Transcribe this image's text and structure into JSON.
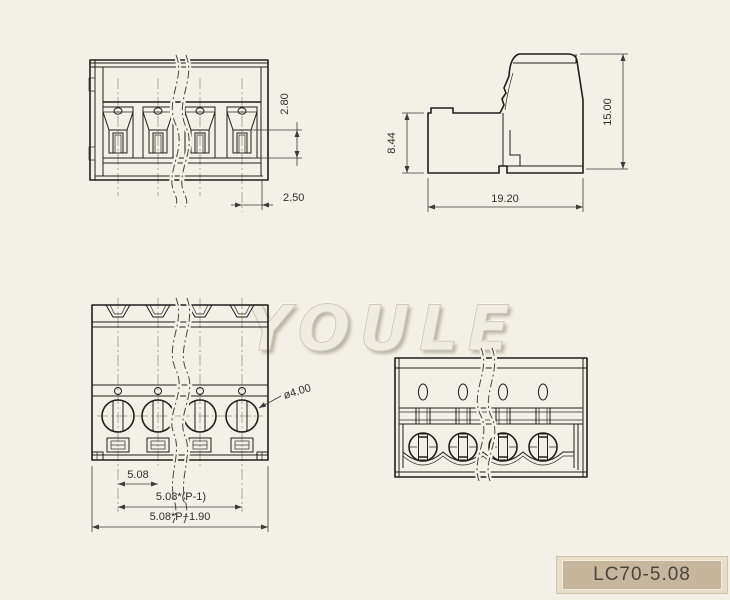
{
  "watermark": "YOULE",
  "title_block": {
    "part_number": "LC70-5.08"
  },
  "dims": {
    "front": {
      "slot_height": "2.80",
      "slot_offset": "2.50"
    },
    "side": {
      "base_height": "8.44",
      "total_height": "15.00",
      "depth": "19.20"
    },
    "top": {
      "pitch": "5.08",
      "span": "5.08*(P-1)",
      "overall": "5.08*P+1.90",
      "screw_diameter": "ø4.00"
    }
  },
  "colors": {
    "background": "#f3f0e7",
    "line": "#1e1e1e",
    "centerline": "#9b968a",
    "title_fill": "#c6b79c",
    "title_frame": "#e7deca",
    "dim_text": "#2e2e2e"
  }
}
